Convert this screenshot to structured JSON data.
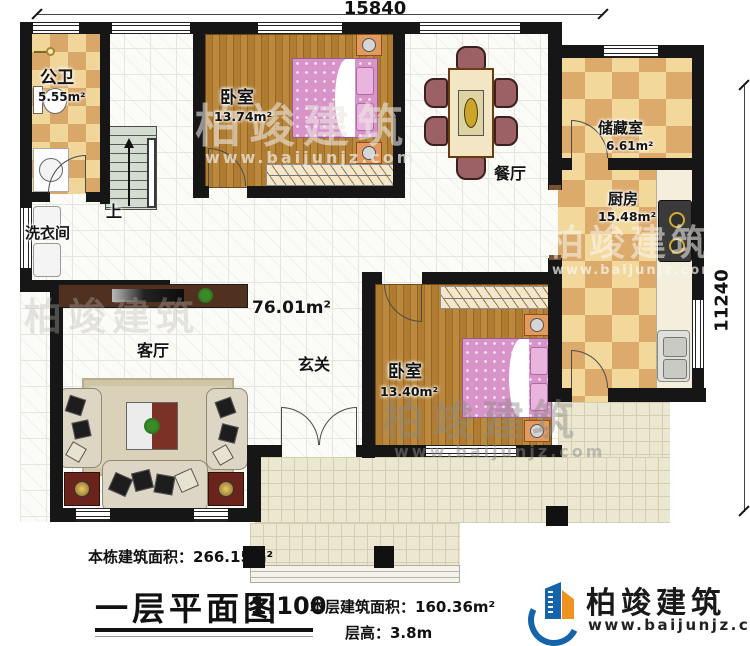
{
  "dimensions": {
    "top": "15840",
    "right": "11240"
  },
  "rooms": {
    "bathroom": {
      "name": "公卫",
      "area": "5.55m²"
    },
    "bedroom1": {
      "name": "卧室",
      "area": "13.74m²"
    },
    "dining": {
      "name": "餐厅"
    },
    "storage": {
      "name": "储藏室",
      "area": "6.61m²"
    },
    "kitchen": {
      "name": "厨房",
      "area": "15.48m²"
    },
    "laundry": {
      "name": "洗衣间"
    },
    "stairs": {
      "label": "上"
    },
    "hall": {
      "name": "玄关",
      "area": "76.01m²"
    },
    "living": {
      "name": "客厅"
    },
    "bedroom2": {
      "name": "卧室",
      "area": "13.40m²"
    }
  },
  "footer": {
    "building_area_label": "本栋建筑面积：266.15m²",
    "plan_title": "一层平面图",
    "plan_scale": "1:100",
    "floor_area_label": "本层建筑面积：160.36m²",
    "floor_height_label": "层高：3.8m"
  },
  "brand": {
    "name": "柏竣建筑",
    "website": "www.baijunjz.com"
  },
  "watermark": {
    "name": "柏竣建筑",
    "website": "www.baijunjz.com"
  },
  "colors": {
    "brand_blue": "#1563aa",
    "brand_orange": "#ef9320",
    "wall": "#161616"
  }
}
